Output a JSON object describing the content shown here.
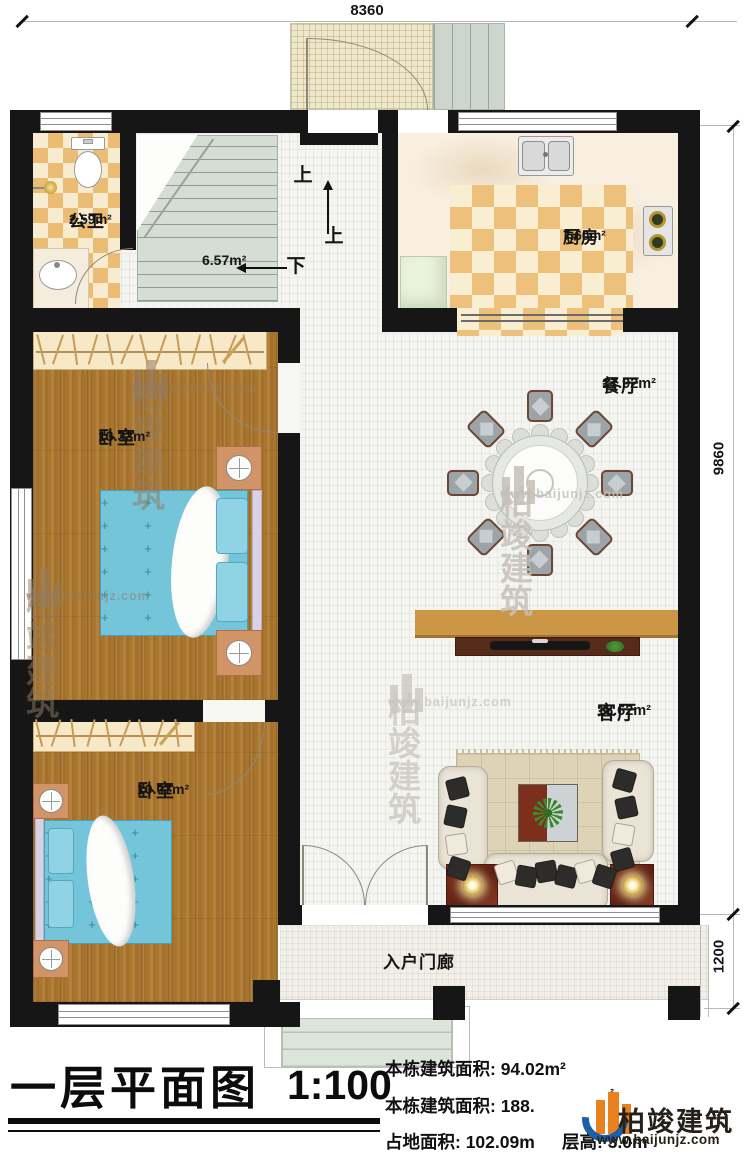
{
  "dimensions": {
    "top": "8360",
    "right_main": "9860",
    "right_porch": "1200"
  },
  "rooms": {
    "bath": {
      "name": "公卫",
      "area": "2.59m²"
    },
    "hall": {
      "area": "6.57m²"
    },
    "kitchen": {
      "name": "厨房",
      "area": "7.60m²"
    },
    "dining": {
      "name": "餐厅",
      "area": "17.92m²"
    },
    "bedroom1": {
      "name": "卧室",
      "area": "13.33m²"
    },
    "living": {
      "name": "客厅",
      "area": "18.62m²"
    },
    "bedroom2": {
      "name": "卧室",
      "area": "10.07m²"
    },
    "porch": {
      "name": "入户门廊"
    }
  },
  "stairs": {
    "up": "上",
    "up2": "上",
    "down": "下"
  },
  "title_block": {
    "title": "一层平面图",
    "scale": "1:100",
    "row1": "本栋建筑面积: 94.02m²",
    "row2": "本栋建筑面积: 188.",
    "row2_sup": "²",
    "row3": "占地面积: 102.09m",
    "row3b": "层高: 3.0m"
  },
  "brand": {
    "name": "柏竣建筑",
    "url": "www.baijunjz.com"
  },
  "colors": {
    "wall": "#161616",
    "wood": "#a9762f",
    "checker": "#eabc74",
    "bed_blue": "#74c4da",
    "logo_orange": "#e8821e",
    "logo_blue": "#1f5fa8"
  }
}
